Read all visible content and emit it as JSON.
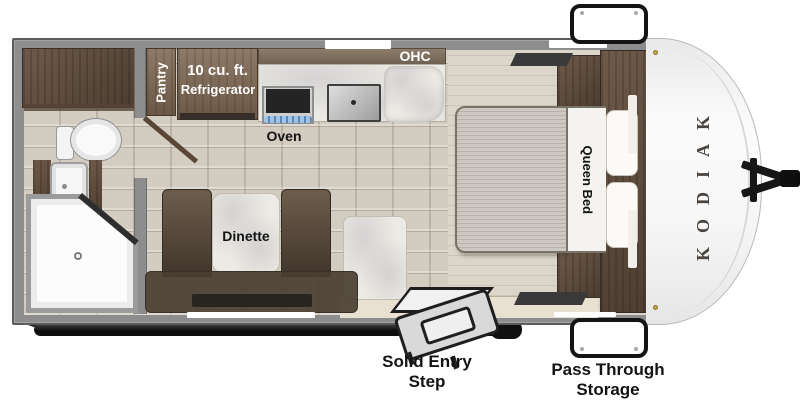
{
  "floorplan": {
    "brand": "KODIAK",
    "description": "travel trailer floor plan"
  },
  "labels": {
    "pantry": "Pantry",
    "refrigerator_size": "10 cu. ft.",
    "refrigerator": "Refrigerator",
    "oven": "Oven",
    "overhead_cabinet": "OHC",
    "queen_bed": "Queen Bed",
    "dinette": "Dinette",
    "solid_entry_step": "Solid Entry\nStep",
    "pass_through_storage": "Pass Through\nStorage"
  },
  "colors": {
    "wall_gray": "#8d8d8d",
    "cabinet_wood": "#6e5a49",
    "floor_tile": "#d3ccc0",
    "bedroom_floor": "#dcd5c9",
    "marble": "#eceae4",
    "upholstery_brown": "#55473a",
    "label_dark": "#141414",
    "label_light": "#ffffff",
    "accent_black": "#161616"
  }
}
